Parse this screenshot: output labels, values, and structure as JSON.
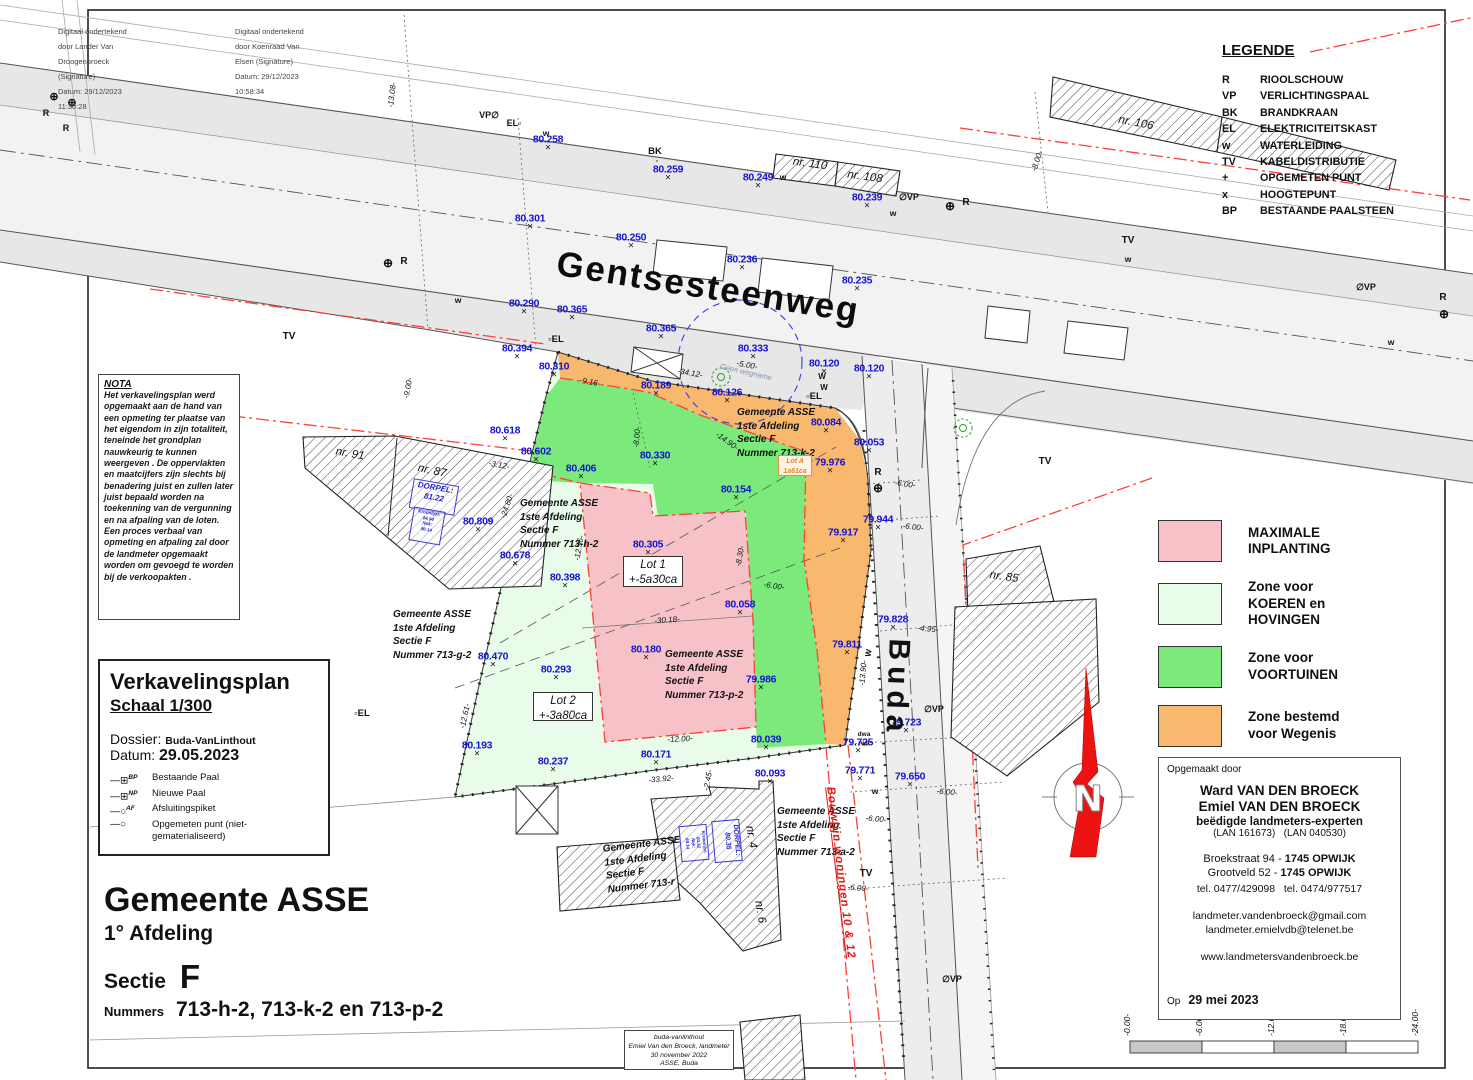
{
  "colors": {
    "pink": "#f6c2c7",
    "lightgreen": "#e9fbe9",
    "green": "#7bea7b",
    "orange": "#f8b96f",
    "red_line": "#ff4038",
    "blue_label": "#1414d2",
    "blue_dash": "#4848dd",
    "north_red": "#ec1313",
    "orange_text": "#e8821e"
  },
  "signatures": {
    "left": [
      "Digitaal ondertekend",
      "door Lander Van",
      "Droogenbroeck",
      "(Signature)",
      "Datum: 29/12/2023",
      "11:30:28"
    ],
    "right": [
      "Digitaal ondertekend",
      "door Koenraad Van",
      "Elsen (Signature)",
      "Datum: 29/12/2023",
      "10:58:34"
    ]
  },
  "legend": {
    "title": "LEGENDE",
    "items": [
      {
        "code": "R",
        "label": "RIOOLSCHOUW"
      },
      {
        "code": "VP",
        "label": "VERLICHTINGSPAAL"
      },
      {
        "code": "BK",
        "label": "BRANDKRAAN"
      },
      {
        "code": "EL",
        "label": "ELEKTRICITEITSKAST"
      },
      {
        "code": "w",
        "label": "WATERLEIDING"
      },
      {
        "code": "TV",
        "label": "KABELDISTRIBUTIE"
      },
      {
        "code": "+",
        "label": "OPGEMETEN PUNT"
      },
      {
        "code": "x",
        "label": "HOOGTEPUNT"
      },
      {
        "code": "BP",
        "label": "BESTAANDE PAALSTEEN"
      }
    ]
  },
  "zones_legend": [
    {
      "key": "pink",
      "lines": [
        "MAXIMALE",
        "INPLANTING"
      ]
    },
    {
      "key": "lightgreen",
      "lines": [
        "Zone voor",
        "KOEREN en",
        "HOVINGEN"
      ]
    },
    {
      "key": "green",
      "lines": [
        "Zone voor",
        "VOORTUINEN"
      ]
    },
    {
      "key": "orange",
      "lines": [
        "Zone bestemd",
        "voor Wegenis"
      ]
    }
  ],
  "nota": {
    "title": "NOTA",
    "body": "Het verkavelingsplan werd opgemaakt aan de hand van een opmeting ter plaatse van het eigendom in zijn totaliteit, teneinde het grondplan nauwkeurig te kunnen weergeven . De oppervlakten en maatcijfers zijn slechts bij benadering juist en zullen later juist bepaald worden na toekenning van de vergunning en na afpaling van de loten. Een proces verbaal van opmeting en afpaling zal door de landmeter opgemaakt worden om gevoegd te worden bij de verkoopakten ."
  },
  "plan_info": {
    "title": "Verkavelingsplan",
    "scale": "Schaal 1/300",
    "dossier_label": "Dossier:",
    "dossier": "Buda-VanLinthout",
    "datum_label": "Datum:",
    "datum": "29.05.2023",
    "symbols": [
      {
        "g": "⊞",
        "sup": "BP",
        "label": "Bestaande Paal"
      },
      {
        "g": "⊞",
        "sup": "NP",
        "label": "Nieuwe Paal"
      },
      {
        "g": "○",
        "sup": "AF",
        "label": "Afsluitingspiket"
      },
      {
        "g": "○",
        "sup": "",
        "label": "Opgemeten punt (niet-gematerialiseerd)"
      }
    ]
  },
  "title_block": {
    "gemeente": "Gemeente ASSE",
    "afdeling": "1° Afdeling",
    "sectie_label": "Sectie",
    "sectie": "F",
    "nummers_label": "Nummers",
    "nummers": "713-h-2, 713-k-2 en 713-p-2"
  },
  "surveyor": {
    "heading": "Opgemaakt door",
    "name1": "Ward VAN DEN BROECK",
    "name2": "Emiel VAN DEN BROECK",
    "title": "beëdigde landmeters-experten",
    "lans": "(LAN 161673)   (LAN 040530)",
    "addr1a": "Broekstraat 94 - ",
    "addr1b": "1745 OPWIJK",
    "addr2a": "Grootveld 52 - ",
    "addr2b": "1745 OPWIJK",
    "phones": "tel. 0477/429098   tel. 0474/977517",
    "email1": "landmeter.vandenbroeck@gmail.com",
    "email2": "landmeter.emielvdb@telenet.be",
    "web": "www.landmetersvandenbroeck.be",
    "date_label": "Op",
    "date": "29 mei 2023"
  },
  "stamp": {
    "lines": [
      "buda-vanlinthout",
      "Emiel Van den Broeck, landmeter",
      "30 november 2022",
      "ASSE, Buda"
    ]
  },
  "streets": {
    "main": "Gentsesteenweg",
    "side": "Buda"
  },
  "lots": {
    "lot1": [
      "Lot 1",
      "+-5a30ca"
    ],
    "lot2": [
      "Lot 2",
      "+-3a80ca"
    ],
    "lotA": [
      "Lot A",
      "1a61ca"
    ]
  },
  "parcels": [
    {
      "x": 737,
      "y": 406,
      "r": 0,
      "lines": [
        "Gemeente ASSE",
        "1ste Afdeling",
        "Sectie F",
        "Nummer 713-k-2"
      ]
    },
    {
      "x": 520,
      "y": 497,
      "r": 0,
      "lines": [
        "Gemeente ASSE",
        "1ste Afdeling",
        "Sectie F",
        "Nummer 713-h-2"
      ]
    },
    {
      "x": 665,
      "y": 648,
      "r": 0,
      "lines": [
        "Gemeente ASSE",
        "1ste Afdeling",
        "Sectie F",
        "Nummer 713-p-2"
      ]
    },
    {
      "x": 393,
      "y": 608,
      "r": 0,
      "lines": [
        "Gemeente ASSE",
        "1ste Afdeling",
        "Sectie F",
        "Nummer 713-g-2"
      ]
    },
    {
      "x": 777,
      "y": 805,
      "r": 0,
      "lines": [
        "Gemeente ASSE",
        "1ste Afdeling",
        "Sectie F",
        "Nummer 713-a-2"
      ]
    },
    {
      "x": 602,
      "y": 843,
      "r": -7,
      "lines": [
        "Gemeente ASSE",
        "1ste Afdeling",
        "Sectie F",
        "Nummer 713-r"
      ]
    }
  ],
  "buildings": [
    {
      "label": "nr. 91",
      "x": 350,
      "y": 454,
      "r": 10
    },
    {
      "label": "nr. 87",
      "x": 432,
      "y": 471,
      "r": 12
    },
    {
      "label": "nr. 85",
      "x": 1004,
      "y": 577,
      "r": 8
    },
    {
      "label": "nr. 106",
      "x": 1136,
      "y": 123,
      "r": 11
    },
    {
      "label": "nr. 110",
      "x": 810,
      "y": 164,
      "r": 8
    },
    {
      "label": "nr. 108",
      "x": 865,
      "y": 177,
      "r": 8
    },
    {
      "label": "nr. 4",
      "x": 751,
      "y": 837,
      "r": 80
    },
    {
      "label": "nr. 6",
      "x": 760,
      "y": 912,
      "r": 80
    }
  ],
  "elevation_points": [
    {
      "v": "80.258",
      "x": 548,
      "y": 143
    },
    {
      "v": "80.259",
      "x": 668,
      "y": 173
    },
    {
      "v": "80.249",
      "x": 758,
      "y": 181
    },
    {
      "v": "80.239",
      "x": 867,
      "y": 201
    },
    {
      "v": "80.301",
      "x": 530,
      "y": 222
    },
    {
      "v": "80.250",
      "x": 631,
      "y": 241
    },
    {
      "v": "80.236",
      "x": 742,
      "y": 263
    },
    {
      "v": "80.235",
      "x": 857,
      "y": 284
    },
    {
      "v": "80.290",
      "x": 524,
      "y": 307
    },
    {
      "v": "80.365",
      "x": 572,
      "y": 313
    },
    {
      "v": "80.365",
      "x": 661,
      "y": 332
    },
    {
      "v": "80.333",
      "x": 753,
      "y": 352
    },
    {
      "v": "80.120",
      "x": 824,
      "y": 367
    },
    {
      "v": "80.120",
      "x": 869,
      "y": 372
    },
    {
      "v": "80.394",
      "x": 517,
      "y": 352
    },
    {
      "v": "80.310",
      "x": 554,
      "y": 370
    },
    {
      "v": "80.189",
      "x": 656,
      "y": 389
    },
    {
      "v": "80.126",
      "x": 727,
      "y": 396
    },
    {
      "v": "80.084",
      "x": 826,
      "y": 426
    },
    {
      "v": "80.053",
      "x": 869,
      "y": 446
    },
    {
      "v": "80.618",
      "x": 505,
      "y": 434
    },
    {
      "v": "80.602",
      "x": 536,
      "y": 455
    },
    {
      "v": "80.406",
      "x": 581,
      "y": 472
    },
    {
      "v": "80.330",
      "x": 655,
      "y": 459
    },
    {
      "v": "80.154",
      "x": 736,
      "y": 493
    },
    {
      "v": "79.976",
      "x": 830,
      "y": 466
    },
    {
      "v": "79.944",
      "x": 878,
      "y": 523
    },
    {
      "v": "79.917",
      "x": 843,
      "y": 536
    },
    {
      "v": "80.809",
      "x": 478,
      "y": 525
    },
    {
      "v": "80.678",
      "x": 515,
      "y": 559
    },
    {
      "v": "80.305",
      "x": 648,
      "y": 548
    },
    {
      "v": "80.398",
      "x": 565,
      "y": 581
    },
    {
      "v": "80.058",
      "x": 740,
      "y": 608
    },
    {
      "v": "80.470",
      "x": 493,
      "y": 660
    },
    {
      "v": "80.293",
      "x": 556,
      "y": 673
    },
    {
      "v": "80.180",
      "x": 646,
      "y": 653
    },
    {
      "v": "79.986",
      "x": 761,
      "y": 683
    },
    {
      "v": "79.811",
      "x": 847,
      "y": 648
    },
    {
      "v": "79.828",
      "x": 893,
      "y": 623
    },
    {
      "v": "79.723",
      "x": 906,
      "y": 726
    },
    {
      "v": "79.725",
      "x": 858,
      "y": 746
    },
    {
      "v": "79.771",
      "x": 860,
      "y": 774
    },
    {
      "v": "79.650",
      "x": 910,
      "y": 780
    },
    {
      "v": "80.193",
      "x": 477,
      "y": 749
    },
    {
      "v": "80.237",
      "x": 553,
      "y": 765
    },
    {
      "v": "80.171",
      "x": 656,
      "y": 758
    },
    {
      "v": "80.039",
      "x": 766,
      "y": 743
    },
    {
      "v": "80.093",
      "x": 770,
      "y": 777
    }
  ],
  "dimensions": [
    {
      "v": "-13.08-",
      "x": 392,
      "y": 95,
      "r": -83
    },
    {
      "v": "-8.00-",
      "x": 1037,
      "y": 161,
      "r": -72
    },
    {
      "v": "-9.00-",
      "x": 408,
      "y": 388,
      "r": -80
    },
    {
      "v": "-5.00-",
      "x": 747,
      "y": 365,
      "r": 10
    },
    {
      "v": "-34.12-",
      "x": 690,
      "y": 373,
      "r": 10
    },
    {
      "v": "-9.16-",
      "x": 590,
      "y": 382,
      "r": 10
    },
    {
      "v": "-8.00-",
      "x": 637,
      "y": 437,
      "r": -85
    },
    {
      "v": "-14.90-",
      "x": 727,
      "y": 441,
      "r": 35
    },
    {
      "v": "-3.12-",
      "x": 499,
      "y": 465,
      "r": 10
    },
    {
      "v": "-24.80-",
      "x": 507,
      "y": 506,
      "r": -72
    },
    {
      "v": "-12.36-",
      "x": 579,
      "y": 548,
      "r": -80
    },
    {
      "v": "-8.30-",
      "x": 740,
      "y": 556,
      "r": -80
    },
    {
      "v": "-6.00-",
      "x": 774,
      "y": 586,
      "r": 8
    },
    {
      "v": "-30.18-",
      "x": 667,
      "y": 620,
      "r": -4
    },
    {
      "v": "-6.00-",
      "x": 913,
      "y": 527,
      "r": 6
    },
    {
      "v": "-4.95-",
      "x": 928,
      "y": 629,
      "r": 5
    },
    {
      "v": "-13.90-",
      "x": 863,
      "y": 673,
      "r": -85
    },
    {
      "v": "-12.00-",
      "x": 680,
      "y": 739,
      "r": -3
    },
    {
      "v": "-12.61-",
      "x": 465,
      "y": 716,
      "r": -78
    },
    {
      "v": "-33.92-",
      "x": 661,
      "y": 779,
      "r": -5
    },
    {
      "v": "-2.45-",
      "x": 708,
      "y": 780,
      "r": -80
    },
    {
      "v": "-6.00-",
      "x": 947,
      "y": 792,
      "r": 5
    },
    {
      "v": "-6.00-",
      "x": 876,
      "y": 819,
      "r": 5
    },
    {
      "v": "-6.00-",
      "x": 858,
      "y": 888,
      "r": 5
    },
    {
      "v": "-6.00-",
      "x": 905,
      "y": 484,
      "r": 8
    }
  ],
  "symbols": [
    {
      "t": "R",
      "x": 404,
      "y": 262,
      "fs": 10
    },
    {
      "t": "R",
      "x": 966,
      "y": 203,
      "fs": 10
    },
    {
      "t": "R",
      "x": 1443,
      "y": 298,
      "fs": 10
    },
    {
      "t": "R",
      "x": 878,
      "y": 473,
      "fs": 10
    },
    {
      "t": "R",
      "x": 46,
      "y": 113,
      "fs": 9
    },
    {
      "t": "R",
      "x": 66,
      "y": 128,
      "fs": 9
    },
    {
      "t": "⊕",
      "x": 388,
      "y": 263,
      "fs": 12
    },
    {
      "t": "⊕",
      "x": 950,
      "y": 206,
      "fs": 12
    },
    {
      "t": "⊕",
      "x": 1444,
      "y": 314,
      "fs": 12
    },
    {
      "t": "⊕",
      "x": 878,
      "y": 488,
      "fs": 12
    },
    {
      "t": "⊕",
      "x": 54,
      "y": 97,
      "fs": 11
    },
    {
      "t": "⊕",
      "x": 72,
      "y": 103,
      "fs": 11
    },
    {
      "t": "∅VP",
      "x": 909,
      "y": 197,
      "fs": 9
    },
    {
      "t": "∅VP",
      "x": 1366,
      "y": 287,
      "fs": 9
    },
    {
      "t": "∅VP",
      "x": 934,
      "y": 709,
      "fs": 9
    },
    {
      "t": "∅VP",
      "x": 952,
      "y": 979,
      "fs": 9
    },
    {
      "t": "VP∅",
      "x": 489,
      "y": 115,
      "fs": 9
    },
    {
      "t": "EL▫",
      "x": 514,
      "y": 123,
      "fs": 9
    },
    {
      "t": "▫EL",
      "x": 556,
      "y": 340,
      "fs": 9.5
    },
    {
      "t": "▫EL",
      "x": 814,
      "y": 397,
      "fs": 9.5
    },
    {
      "t": "▫EL",
      "x": 362,
      "y": 714,
      "fs": 9.5
    },
    {
      "t": "BK",
      "x": 655,
      "y": 152,
      "fs": 9.5
    },
    {
      "t": "▫",
      "x": 657,
      "y": 162,
      "fs": 7
    },
    {
      "t": "TV",
      "x": 289,
      "y": 337,
      "fs": 10
    },
    {
      "t": "TV",
      "x": 1128,
      "y": 241,
      "fs": 10
    },
    {
      "t": "TV",
      "x": 1045,
      "y": 462,
      "fs": 10
    },
    {
      "t": "TV",
      "x": 866,
      "y": 874,
      "fs": 10
    },
    {
      "t": "w",
      "x": 546,
      "y": 133,
      "fs": 8.5
    },
    {
      "t": "w",
      "x": 783,
      "y": 177,
      "fs": 8.5
    },
    {
      "t": "w",
      "x": 893,
      "y": 213,
      "fs": 8.5
    },
    {
      "t": "w",
      "x": 1128,
      "y": 259,
      "fs": 8.5
    },
    {
      "t": "w",
      "x": 458,
      "y": 300,
      "fs": 8.5
    },
    {
      "t": "w",
      "x": 875,
      "y": 791,
      "fs": 8.5
    },
    {
      "t": "w",
      "x": 1391,
      "y": 342,
      "fs": 8.5
    },
    {
      "t": "W",
      "x": 822,
      "y": 377,
      "fs": 8
    },
    {
      "t": "W",
      "x": 824,
      "y": 388,
      "fs": 8
    },
    {
      "t": "W",
      "x": 869,
      "y": 653,
      "fs": 8,
      "r": -80
    },
    {
      "t": "dwa",
      "x": 864,
      "y": 735,
      "fs": 6.5
    },
    {
      "t": "rwa",
      "x": 864,
      "y": 744,
      "fs": 6.5
    }
  ],
  "blue_boxes": [
    {
      "x": 434,
      "y": 497,
      "w": 44,
      "h": 28,
      "r": 10,
      "fs": 8,
      "lines": [
        "DORPEL:",
        "81.22"
      ]
    },
    {
      "x": 427,
      "y": 526,
      "w": 30,
      "h": 32,
      "r": 10,
      "fs": 4.5,
      "lines": [
        "Kroonlijst:",
        "84.94",
        "Nok:",
        "90.14"
      ]
    },
    {
      "x": 727,
      "y": 841,
      "w": 40,
      "h": 26,
      "r": 85,
      "fs": 7,
      "lines": [
        "DORPEL:",
        "80.35"
      ]
    },
    {
      "x": 694,
      "y": 843,
      "w": 34,
      "h": 26,
      "r": 85,
      "fs": 4.5,
      "lines": [
        "Kroonlijst:",
        "84.52",
        "Nok:",
        "89.14"
      ]
    }
  ],
  "misc": {
    "north": "N",
    "geen_wegname": "Geen wegname",
    "bouwlijn": "Bouwlijn woningen 10 & 12"
  },
  "scalebar": {
    "labels": [
      "-0.00-",
      "-6.00-",
      "-12.00-",
      "-18.00-",
      "-24.00-"
    ],
    "ticks": [
      1130,
      1202,
      1274,
      1346,
      1418
    ]
  }
}
